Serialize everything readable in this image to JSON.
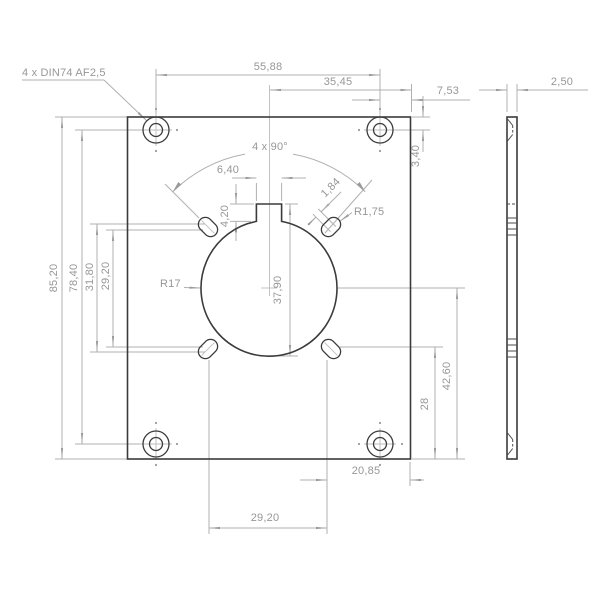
{
  "drawing": {
    "annotations": {
      "hole_callout": "4 x DIN74 AF2,5",
      "pattern_angle": "4 x 90°",
      "bore_radius": "R17",
      "slot_radius": "R1,75"
    },
    "dimensions": {
      "hole_span_horizontal": "55,88",
      "center_to_right_edge": "35,45",
      "hole_to_right_edge": "7,53",
      "plate_thickness": "2,50",
      "hole_to_top_edge": "3,40",
      "plate_height": "85,20",
      "hole_span_vertical": "78,40",
      "slot_outer_span_vertical": "31,80",
      "slot_inner_span_vertical": "29,20",
      "keyway_width": "6,40",
      "keyway_depth": "4,20",
      "slot_length": "1,84",
      "opening_height": "37,90",
      "center_to_bottom_edge": "42,60",
      "slot_to_bottom_edge": "28",
      "slot_to_right_edge": "20,85",
      "slot_span_horizontal": "29,20"
    }
  }
}
